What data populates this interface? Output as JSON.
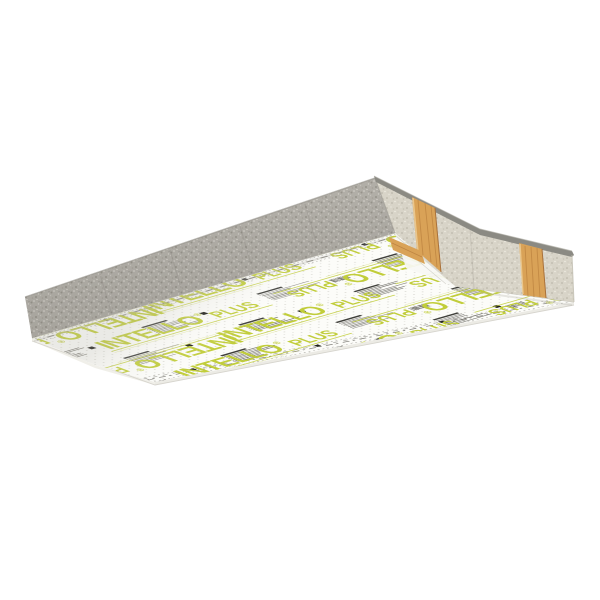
{
  "product": {
    "brand": "INTELLO",
    "registered_mark": "®",
    "variant": "PLUS"
  },
  "branding": {
    "print_green": "#c1cd3a"
  },
  "materials": {
    "membrane_white": "#fcfcf9",
    "fine_print_ink": "#55534c",
    "pictogram_black": "#1e1e1a",
    "dot_ink": "#a5a49a",
    "insulation_grey_dark": "#b1aea7",
    "insulation_grey_light": "#d8d4c8",
    "panel_top_edge_grey": "#8b8a83",
    "wood": "#d9a257",
    "wood_grain": "#bd8440",
    "visible_wood_studs": 2
  },
  "scene": {
    "background": "#ffffff",
    "brand_logo_rows": 5,
    "brand_logo_column_step": 172
  }
}
